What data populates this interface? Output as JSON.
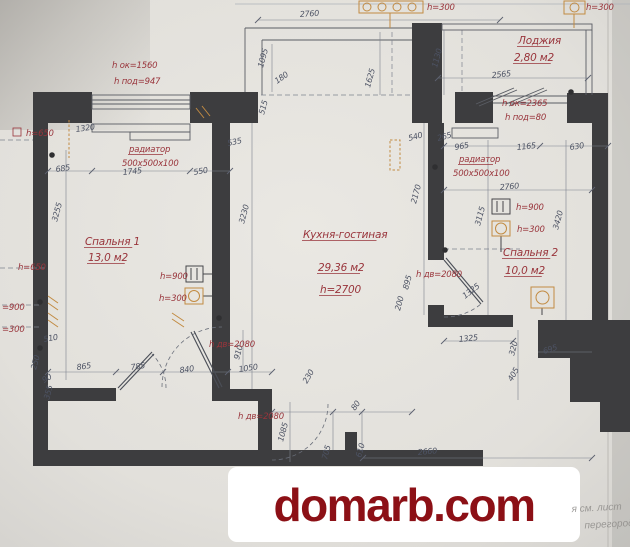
{
  "colors": {
    "wall": "#3d3d3f",
    "dimension_text": "#4d5364",
    "red_label": "#99343b",
    "electrical_orange": "#c28b42",
    "watermark_red": "#8c1016",
    "paper": "#e9e7e2"
  },
  "plan": {
    "rooms": [
      {
        "label_lines": [
          {
            "t": "Спальня 1",
            "x": 85,
            "y": 245
          },
          {
            "t": "13,0 м2",
            "x": 88,
            "y": 261
          }
        ]
      },
      {
        "label_lines": [
          {
            "t": "Кухня-гостиная",
            "x": 303,
            "y": 238
          },
          {
            "t": "29,36 м2",
            "x": 318,
            "y": 271
          },
          {
            "t": "h=2700",
            "x": 320,
            "y": 293
          }
        ]
      },
      {
        "label_lines": [
          {
            "t": "Спальня 2",
            "x": 503,
            "y": 256
          },
          {
            "t": "10,0 м2",
            "x": 505,
            "y": 274
          }
        ]
      },
      {
        "label_lines": [
          {
            "t": "Лоджия",
            "x": 518,
            "y": 44
          },
          {
            "t": "2,80 м2",
            "x": 514,
            "y": 61
          }
        ]
      }
    ],
    "red_labels": [
      {
        "t": "h ок=1560",
        "x": 112,
        "y": 68
      },
      {
        "t": "h под=947",
        "x": 114,
        "y": 84
      },
      {
        "t": "h=300",
        "x": 427,
        "y": 10
      },
      {
        "t": "h=300",
        "x": 586,
        "y": 10
      },
      {
        "t": "h=650",
        "x": 26,
        "y": 136
      },
      {
        "t": "h=650",
        "x": 18,
        "y": 270
      },
      {
        "t": "=900",
        "x": 2,
        "y": 310
      },
      {
        "t": "=300",
        "x": 2,
        "y": 332
      },
      {
        "t": "радиатор",
        "x": 129,
        "y": 152,
        "u": true
      },
      {
        "t": "500х500х100",
        "x": 122,
        "y": 166
      },
      {
        "t": "радиатор",
        "x": 459,
        "y": 162,
        "u": true
      },
      {
        "t": "500х500х100",
        "x": 453,
        "y": 176
      },
      {
        "t": "h ок=2365",
        "x": 502,
        "y": 106
      },
      {
        "t": "h под=80",
        "x": 505,
        "y": 120
      },
      {
        "t": "h=900",
        "x": 160,
        "y": 279
      },
      {
        "t": "h=300",
        "x": 159,
        "y": 301
      },
      {
        "t": "h=900",
        "x": 516,
        "y": 210
      },
      {
        "t": "h=300",
        "x": 517,
        "y": 232
      },
      {
        "t": "h дв=2080",
        "x": 209,
        "y": 347
      },
      {
        "t": "h дв=2080",
        "x": 238,
        "y": 419
      },
      {
        "t": "h дв=2080",
        "x": 416,
        "y": 277
      }
    ],
    "dimensions": [
      {
        "t": "2760",
        "x": 300,
        "y": 17,
        "r": -4
      },
      {
        "t": "1095",
        "x": 263,
        "y": 68,
        "r": -75
      },
      {
        "t": "180",
        "x": 277,
        "y": 84,
        "r": -35
      },
      {
        "t": "515",
        "x": 264,
        "y": 115,
        "r": -75
      },
      {
        "t": "1625",
        "x": 370,
        "y": 88,
        "r": -75
      },
      {
        "t": "1130",
        "x": 437,
        "y": 68,
        "r": -75
      },
      {
        "t": "2565",
        "x": 492,
        "y": 78,
        "r": -6
      },
      {
        "t": "535",
        "x": 228,
        "y": 146,
        "r": -12
      },
      {
        "t": "550",
        "x": 194,
        "y": 175,
        "r": -10
      },
      {
        "t": "1320",
        "x": 76,
        "y": 132,
        "r": -8
      },
      {
        "t": "685",
        "x": 56,
        "y": 172,
        "r": -8
      },
      {
        "t": "1745",
        "x": 123,
        "y": 175,
        "r": -6
      },
      {
        "t": "540",
        "x": 409,
        "y": 141,
        "r": -15
      },
      {
        "t": "265",
        "x": 438,
        "y": 141,
        "r": -15
      },
      {
        "t": "965",
        "x": 455,
        "y": 150,
        "r": -10
      },
      {
        "t": "1165",
        "x": 517,
        "y": 150,
        "r": -6
      },
      {
        "t": "630",
        "x": 570,
        "y": 150,
        "r": -8
      },
      {
        "t": "2760",
        "x": 500,
        "y": 190,
        "r": -5
      },
      {
        "t": "3255",
        "x": 57,
        "y": 222,
        "r": -75
      },
      {
        "t": "3230",
        "x": 244,
        "y": 224,
        "r": -75
      },
      {
        "t": "2170",
        "x": 416,
        "y": 204,
        "r": -75
      },
      {
        "t": "3115",
        "x": 480,
        "y": 226,
        "r": -75
      },
      {
        "t": "3420",
        "x": 558,
        "y": 230,
        "r": -75
      },
      {
        "t": "895",
        "x": 408,
        "y": 290,
        "r": -75
      },
      {
        "t": "200",
        "x": 400,
        "y": 311,
        "r": -75
      },
      {
        "t": "510",
        "x": 44,
        "y": 342,
        "r": -10
      },
      {
        "t": "250",
        "x": 36,
        "y": 370,
        "r": -75
      },
      {
        "t": "90",
        "x": 44,
        "y": 383,
        "r": -30
      },
      {
        "t": "355",
        "x": 49,
        "y": 400,
        "r": -75
      },
      {
        "t": "865",
        "x": 77,
        "y": 370,
        "r": -8
      },
      {
        "t": "785",
        "x": 131,
        "y": 370,
        "r": -8
      },
      {
        "t": "840",
        "x": 180,
        "y": 373,
        "r": -8
      },
      {
        "t": "1050",
        "x": 239,
        "y": 372,
        "r": -8
      },
      {
        "t": "910",
        "x": 239,
        "y": 360,
        "r": -75
      },
      {
        "t": "230",
        "x": 307,
        "y": 384,
        "r": -60
      },
      {
        "t": "1085",
        "x": 283,
        "y": 442,
        "r": -75
      },
      {
        "t": "705",
        "x": 327,
        "y": 460,
        "r": -75
      },
      {
        "t": "610",
        "x": 361,
        "y": 458,
        "r": -75
      },
      {
        "t": "80",
        "x": 355,
        "y": 411,
        "r": -55
      },
      {
        "t": "2660",
        "x": 418,
        "y": 455,
        "r": -5
      },
      {
        "t": "1325",
        "x": 459,
        "y": 342,
        "r": -6
      },
      {
        "t": "1325",
        "x": 465,
        "y": 299,
        "r": -38
      },
      {
        "t": "320",
        "x": 514,
        "y": 356,
        "r": -75
      },
      {
        "t": "695",
        "x": 544,
        "y": 354,
        "r": -18
      },
      {
        "t": "405",
        "x": 512,
        "y": 382,
        "r": -60
      }
    ]
  },
  "watermark": {
    "text": "domarb.com"
  },
  "corner_text": {
    "line1": "я см. лист",
    "line2": "перегород"
  }
}
